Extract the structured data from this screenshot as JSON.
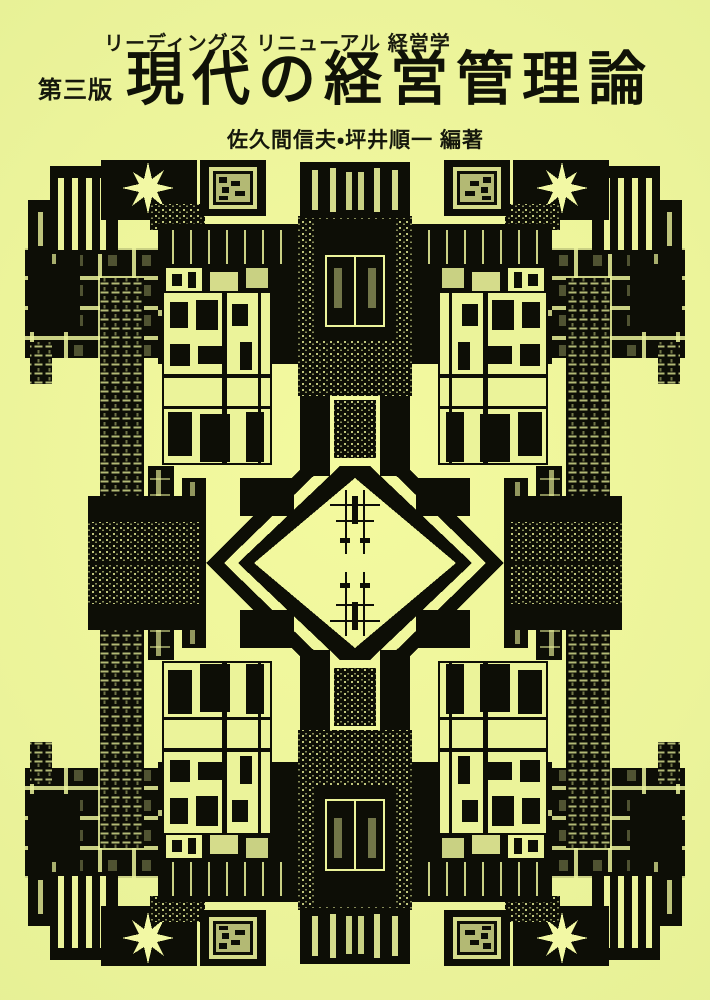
{
  "page": {
    "background": "#ebf39a",
    "ink": "#14160b"
  },
  "cover": {
    "series_label": "リーディングス リニューアル 経営学",
    "edition_label": "第三版",
    "title": "現代の経営管理論",
    "authors_label": "佐久間信夫・坪井順一 編著"
  },
  "artwork": {
    "name": "mirrored-architecture-collage",
    "alt": "黒一色の建築写真コラージュ（左右・上下対称、中央に六角形の余白）"
  }
}
